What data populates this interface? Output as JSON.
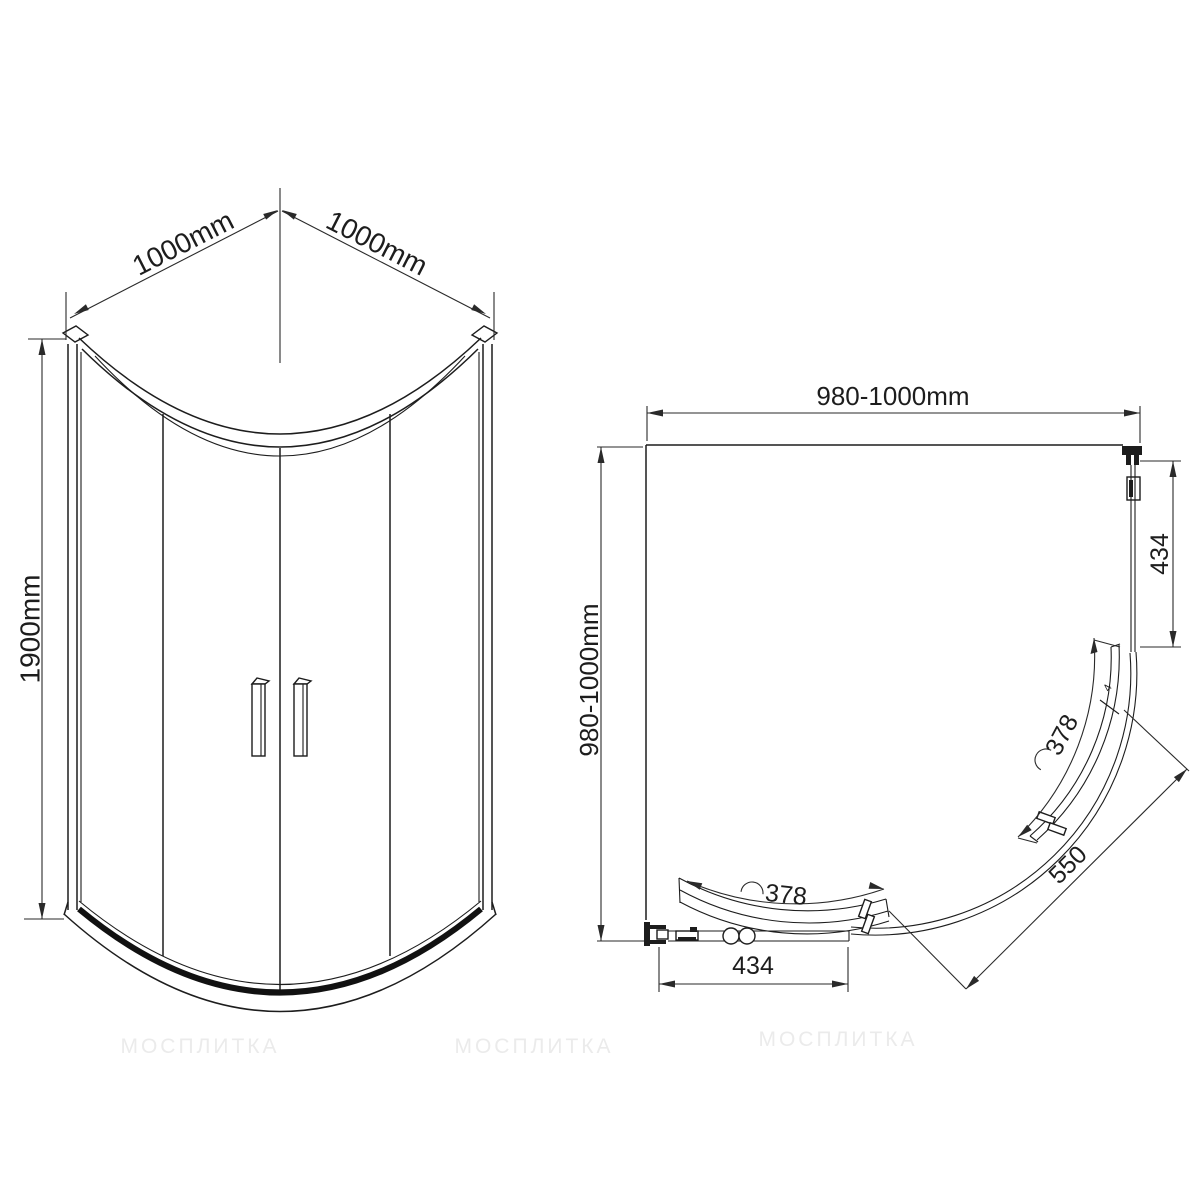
{
  "drawing": {
    "watermark": "МОСПЛИТКА",
    "front_view": {
      "width_left": "1000mm",
      "width_right": "1000mm",
      "height": "1900mm"
    },
    "plan_view": {
      "width": "980-1000mm",
      "depth": "980-1000mm",
      "right_panel": "434",
      "bottom_panel": "434",
      "door_top": "378",
      "door_bottom": "378",
      "entry_radius": "550",
      "glass_thickness": "4"
    },
    "colors": {
      "line": "#1d1d1d",
      "watermark": "#ebebeb",
      "background": "#ffffff"
    }
  }
}
